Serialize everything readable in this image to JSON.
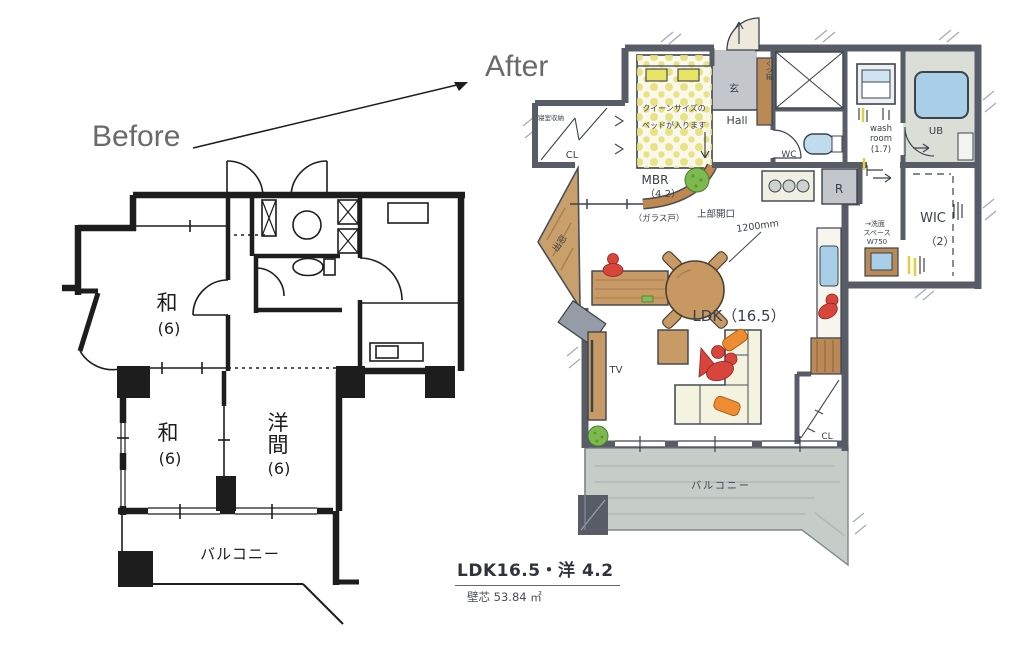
{
  "annotations": {
    "before": "Before",
    "after": "After"
  },
  "caption": {
    "title": "LDK16.5・洋 4.2",
    "area": "壁芯 53.84 ㎡"
  },
  "before_plan": {
    "room_top": {
      "name": "和",
      "size": "(6)"
    },
    "room_bottom_left": {
      "name": "和",
      "size": "(6)"
    },
    "room_bottom_right": {
      "l1": "洋",
      "l2": "間",
      "size": "(6)"
    },
    "balcony": "バルコニー"
  },
  "after_plan": {
    "closet_top": {
      "label": "寝室収納",
      "cl": "CL"
    },
    "bed_note": {
      "l1": "クイーンサイズの",
      "l2": "ベッドが入ります"
    },
    "mbr": {
      "name": "MBR",
      "size": "（4.2）"
    },
    "entrance": "玄",
    "shoe_box": "くつ箱",
    "hall": "Hall",
    "wc": "WC",
    "washroom": {
      "l1": "wash",
      "l2": "room",
      "l3": "(1.7)"
    },
    "ub": "UB",
    "wic": {
      "name": "WIC",
      "size": "（2）"
    },
    "fridge": "R",
    "wash_space": {
      "l1": "→洗面",
      "l2": "スペース",
      "l3": "W750"
    },
    "glass_door": "（ガラス戸）",
    "opening": {
      "label": "上部開口",
      "width": "1200mm"
    },
    "ldk": "LDK（16.5）",
    "tv": "TV",
    "bay_window": "出窓",
    "closet_bottom": "CL",
    "balcony": "バルコニー"
  },
  "colors": {
    "wall": "#575c66",
    "wood": "#c89a66",
    "water": "#a9cfe8",
    "bed_yellow": "#e9e464",
    "balcony": "#c6ccc8",
    "accent_red": "#d8453c",
    "accent_orange": "#ef8b30",
    "plant_green": "#7cba4f"
  }
}
